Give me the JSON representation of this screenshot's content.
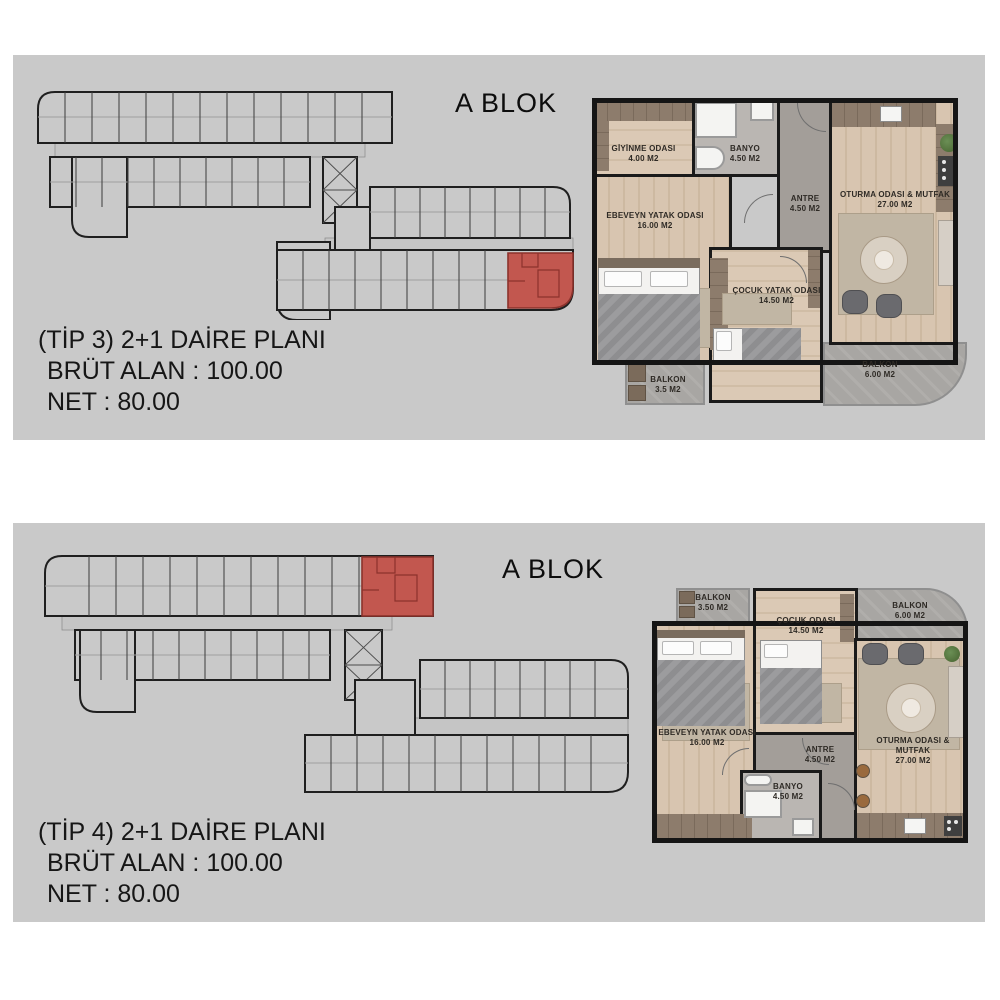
{
  "page_background": "#ffffff",
  "colors": {
    "panel_bg": "#c9c9c9",
    "highlight_red": "#c2574f",
    "wall_black": "#1a1a1a",
    "wood_floor": "#d7c4ae",
    "hall_tile_gray": "#a39e99",
    "balcony_gray": "#a8a6a3",
    "counter_brown": "#8d7c6c"
  },
  "panels": [
    {
      "block_title": "A BLOK",
      "plan_type": "(TİP 3) 2+1 DAİRE PLANI",
      "gross_area": "BRÜT ALAN : 100.00",
      "net_area": "NET : 80.00",
      "rooms": [
        {
          "name": "GİYİNME ODASI",
          "area": "4.00 M2"
        },
        {
          "name": "BANYO",
          "area": "4.50 M2"
        },
        {
          "name": "ANTRE",
          "area": "4.50 M2"
        },
        {
          "name": "OTURMA ODASI & MUTFAK",
          "area": "27.00 M2"
        },
        {
          "name": "EBEVEYN YATAK ODASI",
          "area": "16.00 M2"
        },
        {
          "name": "ÇOCUK YATAK ODASI",
          "area": "14.50 M2"
        },
        {
          "name": "BALKON",
          "area": "3.5 M2"
        },
        {
          "name": "BALKON",
          "area": "6.00 M2"
        }
      ]
    },
    {
      "block_title": "A BLOK",
      "plan_type": "(TİP 4) 2+1 DAİRE PLANI",
      "gross_area": "BRÜT ALAN : 100.00",
      "net_area": "NET : 80.00",
      "rooms": [
        {
          "name": "BALKON",
          "area": "3.50 M2"
        },
        {
          "name": "ÇOCUK ODASI",
          "area": "14.50 M2"
        },
        {
          "name": "BALKON",
          "area": "6.00 M2"
        },
        {
          "name": "EBEVEYN YATAK ODASI",
          "area": "16.00 M2"
        },
        {
          "name": "ANTRE",
          "area": "4.50 M2"
        },
        {
          "name": "BANYO",
          "area": "4.50 M2"
        },
        {
          "name": "OTURMA ODASI & MUTFAK",
          "area": "27.00 M2"
        }
      ]
    }
  ]
}
